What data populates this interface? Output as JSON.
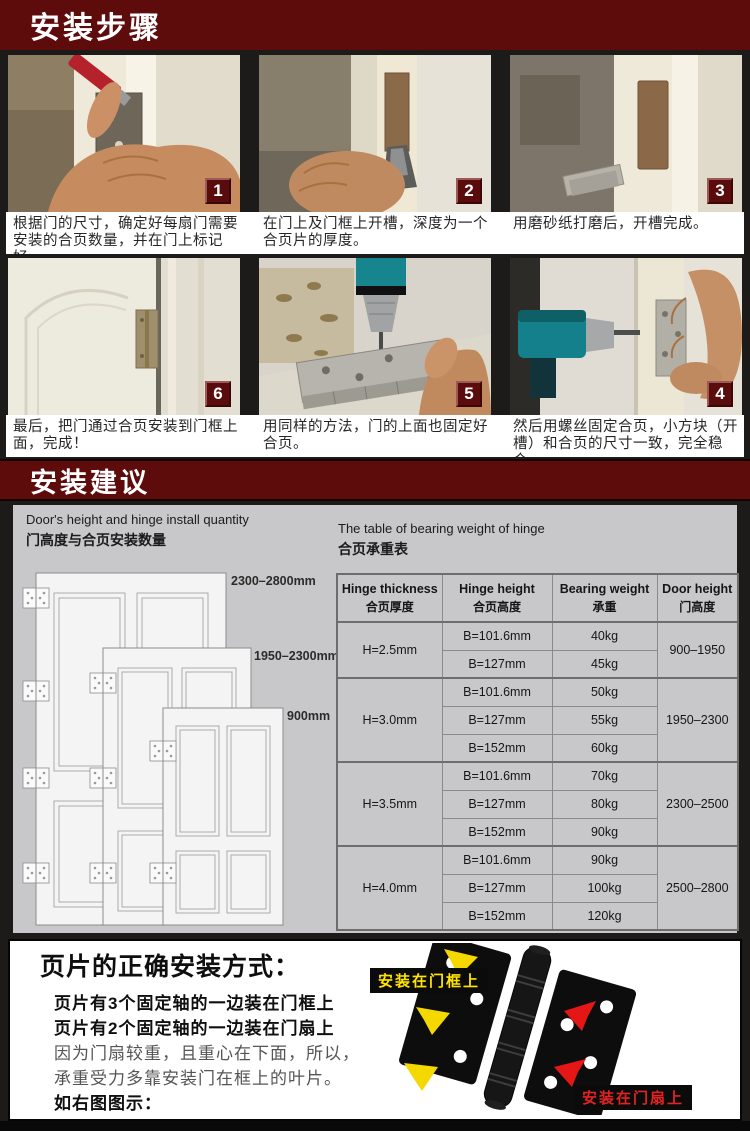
{
  "colors": {
    "maroon": "#5e0b0c",
    "dark_bg": "#1c1b1a",
    "panel_gray": "#c8c8ca",
    "label_yellow": "#ffe400",
    "label_red": "#e32222"
  },
  "headers": {
    "steps": "安装步骤",
    "advice": "安装建议"
  },
  "steps": [
    {
      "num": "1",
      "caption": "根据门的尺寸，确定好每扇门需要安装的合页数量，并在门上标记好。",
      "photo": "mark-hinge-position"
    },
    {
      "num": "2",
      "caption": "在门上及门框上开槽，深度为一个合页片的厚度。",
      "photo": "chisel-groove"
    },
    {
      "num": "3",
      "caption": "用磨砂纸打磨后，开槽完成。",
      "photo": "groove-complete"
    },
    {
      "num": "6",
      "caption": "最后，把门通过合页安装到门框上面，完成！",
      "photo": "door-installed"
    },
    {
      "num": "5",
      "caption": "用同样的方法，门的上面也固定好合页。",
      "photo": "drill-top-hinge"
    },
    {
      "num": "4",
      "caption": "然后用螺丝固定合页，小方块（开槽）和合页的尺寸一致，完全稳合。",
      "photo": "screw-hinge-on-frame"
    }
  ],
  "advice": {
    "left_title_en": "Door's height and hinge install quantity",
    "left_title_zh": "门高度与合页安装数量",
    "right_title_en": "The table of bearing weight of hinge",
    "right_title_zh": "合页承重表",
    "door_labels": [
      "2300–2800mm",
      "1950–2300mm",
      "900mm"
    ],
    "table": {
      "headers": [
        {
          "en": "Hinge thickness",
          "zh": "合页厚度"
        },
        {
          "en": "Hinge height",
          "zh": "合页高度"
        },
        {
          "en": "Bearing weight",
          "zh": "承重"
        },
        {
          "en": "Door height",
          "zh": "门高度"
        }
      ],
      "groups": [
        {
          "thickness": "H=2.5mm",
          "door": "900–1950",
          "rows": [
            {
              "height": "B=101.6mm",
              "weight": "40kg"
            },
            {
              "height": "B=127mm",
              "weight": "45kg"
            }
          ]
        },
        {
          "thickness": "H=3.0mm",
          "door": "1950–2300",
          "rows": [
            {
              "height": "B=101.6mm",
              "weight": "50kg"
            },
            {
              "height": "B=127mm",
              "weight": "55kg"
            },
            {
              "height": "B=152mm",
              "weight": "60kg"
            }
          ]
        },
        {
          "thickness": "H=3.5mm",
          "door": "2300–2500",
          "rows": [
            {
              "height": "B=101.6mm",
              "weight": "70kg"
            },
            {
              "height": "B=127mm",
              "weight": "80kg"
            },
            {
              "height": "B=152mm",
              "weight": "90kg"
            }
          ]
        },
        {
          "thickness": "H=4.0mm",
          "door": "2500–2800",
          "rows": [
            {
              "height": "B=101.6mm",
              "weight": "90kg"
            },
            {
              "height": "B=127mm",
              "weight": "100kg"
            },
            {
              "height": "B=152mm",
              "weight": "120kg"
            }
          ]
        }
      ]
    }
  },
  "bottom": {
    "heading": "页片的正确安装方式：",
    "lines": [
      "页片有3个固定轴的一边装在门框上",
      "页片有2个固定轴的一边装在门扇上",
      "因为门扇较重，且重心在下面，所以，",
      "承重受力多靠安装门在框上的叶片。",
      "如右图图示："
    ],
    "frame_label": "安装在门框上",
    "leaf_label": "安装在门扇上"
  }
}
